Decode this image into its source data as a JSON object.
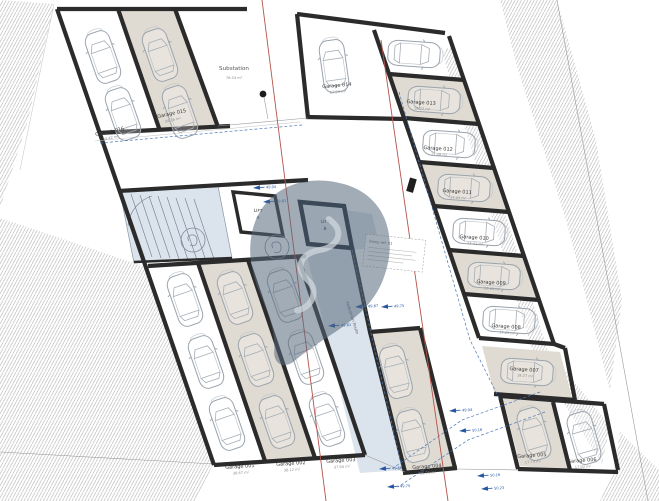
{
  "plan": {
    "substation": {
      "name": "Substation",
      "area": "76.54 m²"
    },
    "lifts": [
      {
        "line1": "LIFT",
        "line2": "A"
      },
      {
        "line1": "LIFT",
        "line2": "B"
      }
    ],
    "ramp_note": "Ramp ref: 01",
    "route": "Pedestrian Route",
    "garages": [
      {
        "name": "Garage 001",
        "area": "38.67 m²"
      },
      {
        "name": "Garage 002",
        "area": "38.12 m²"
      },
      {
        "name": "Garage 003",
        "area": "37.94 m²"
      },
      {
        "name": "Garage 004",
        "area": "35.21 m²"
      },
      {
        "name": "Garage 005",
        "area": "17.74 m²"
      },
      {
        "name": "Garage 006",
        "area": "17.92 m²"
      },
      {
        "name": "Garage 007",
        "area": "18.27 m²"
      },
      {
        "name": "Garage 008",
        "area": "17.41 m²"
      },
      {
        "name": "Garage 009",
        "area": "17.41 m²"
      },
      {
        "name": "Garage 010",
        "area": "17.41 m²"
      },
      {
        "name": "Garage 011",
        "area": "17.41 m²"
      },
      {
        "name": "Garage 012",
        "area": "17.48 m²"
      },
      {
        "name": "Garage 013",
        "area": "18.22 m²"
      },
      {
        "name": "Garage 014",
        "area": "17.53 m²"
      },
      {
        "name": "Garage 015",
        "area": "34.16 m²"
      },
      {
        "name": "Garage 016",
        "area": "34.42 m²"
      }
    ],
    "levels": [
      "49.94",
      "49.81",
      "49.87",
      "49.75",
      "49.81",
      "49.94",
      "50.16",
      "49.68",
      "49.75",
      "50.16",
      "50.23"
    ]
  },
  "colors": {
    "wall": "#2b2b2b",
    "shaded_stall": "#e0dbd2",
    "blue_zone": "#dbe3ec",
    "section_line": "#b5524c",
    "level_marker": "#2456a4",
    "watermark": "#56677a"
  }
}
